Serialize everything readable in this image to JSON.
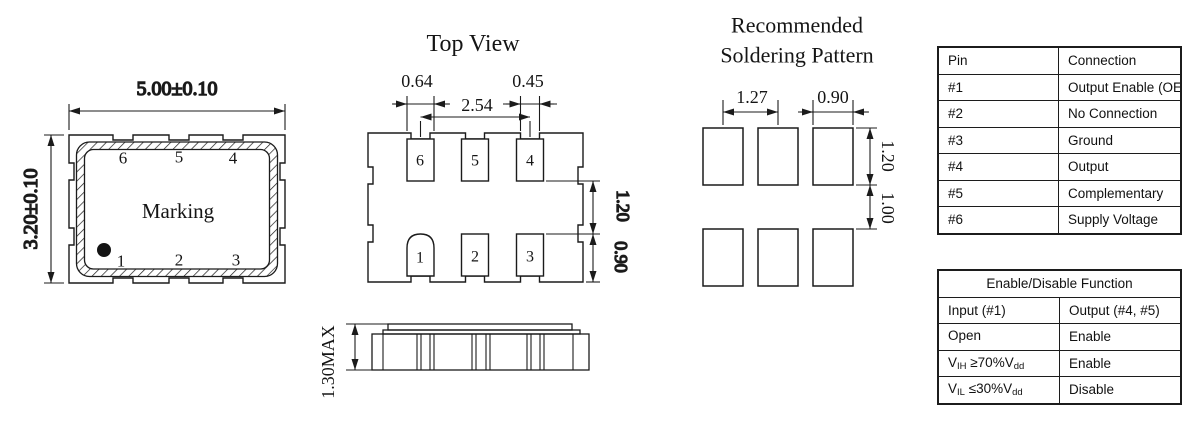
{
  "package_drawing": {
    "width_dim": "5.00±0.10",
    "height_dim": "3.20±0.10",
    "marking": "Marking",
    "top_pins": [
      "6",
      "5",
      "4"
    ],
    "bottom_pins": [
      "1",
      "2",
      "3"
    ]
  },
  "top_view": {
    "title": "Top View",
    "top_pins": [
      "6",
      "5",
      "4"
    ],
    "bottom_pins": [
      "1",
      "2",
      "3"
    ],
    "dim_pad_width": "0.64",
    "dim_pitch": "2.54",
    "dim_notch_width": "0.45",
    "dim_row_gap": "1.20",
    "dim_pad_height": "0.90"
  },
  "side_view": {
    "dim_height": "1.30MAX"
  },
  "soldering_pattern": {
    "title_line1": "Recommended",
    "title_line2": "Soldering Pattern",
    "dim_pitch": "1.27",
    "dim_pad_width": "0.90",
    "dim_pad_height": "1.20",
    "dim_row_gap": "1.00"
  },
  "pin_table": {
    "headers": [
      "Pin",
      "Connection"
    ],
    "rows": [
      [
        "#1",
        "Output Enable (OE)"
      ],
      [
        "#2",
        "No Connection"
      ],
      [
        "#3",
        "Ground"
      ],
      [
        "#4",
        "Output"
      ],
      [
        "#5",
        "Complementary"
      ],
      [
        "#6",
        "Supply Voltage"
      ]
    ]
  },
  "enable_table": {
    "title": "Enable/Disable Function",
    "headers": [
      "Input (#1)",
      "Output (#4, #5)"
    ],
    "rows": [
      {
        "input": {
          "base": "Open",
          "sub1": "",
          "mid": "",
          "sub2": ""
        },
        "output": "Enable"
      },
      {
        "input": {
          "base": "V",
          "sub1": "IH",
          "mid": " ≥70%V",
          "sub2": "dd"
        },
        "output": "Enable"
      },
      {
        "input": {
          "base": "V",
          "sub1": "IL",
          "mid": " ≤30%V",
          "sub2": "dd"
        },
        "output": "Disable"
      }
    ]
  },
  "colors": {
    "line": "#1b1b1b",
    "background": "#ffffff"
  }
}
